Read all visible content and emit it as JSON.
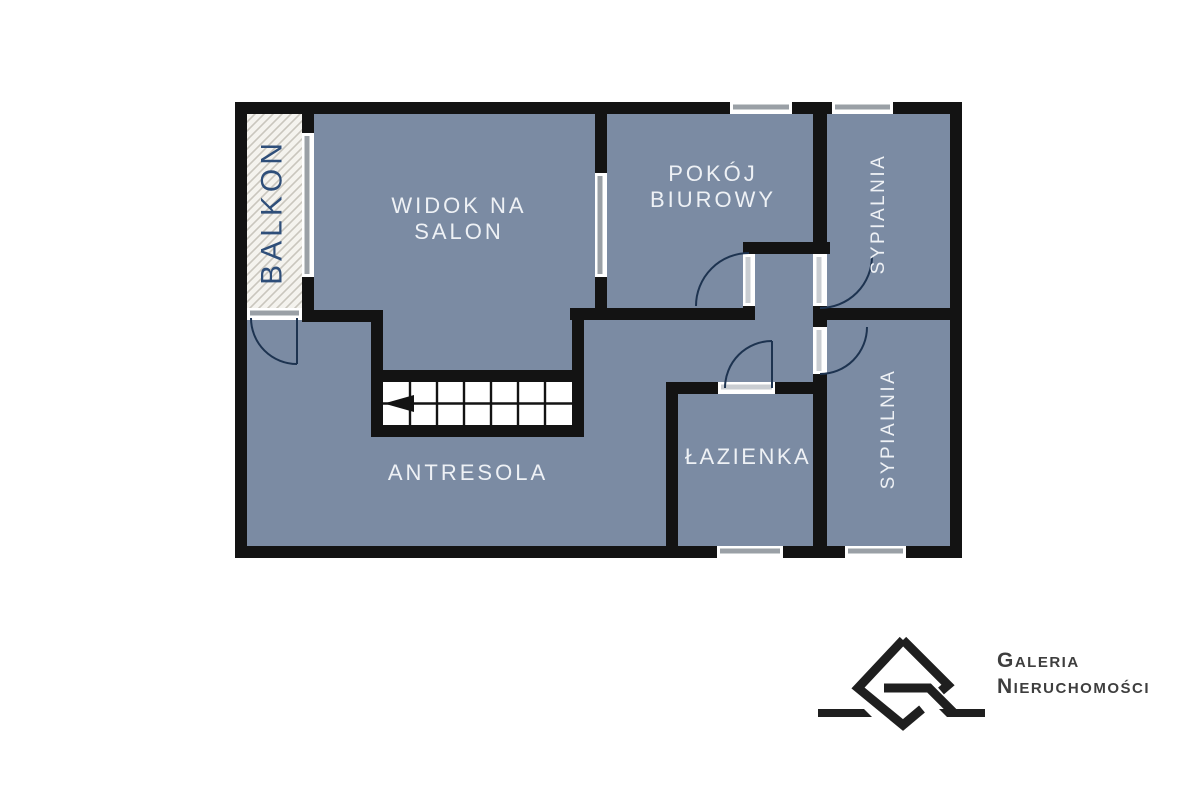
{
  "title": "Floor plan - mezzanine level",
  "rooms": {
    "balcony": {
      "label": "BALKON"
    },
    "salon": {
      "line1": "WIDOK NA",
      "line2": "SALON"
    },
    "office": {
      "line1": "POKÓJ",
      "line2": "BIUROWY"
    },
    "bedroom_top": {
      "label": "SYPIALNIA"
    },
    "bedroom_bottom": {
      "label": "SYPIALNIA"
    },
    "bathroom": {
      "label": "ŁAZIENKA"
    },
    "mezzanine": {
      "label": "ANTRESOLA"
    }
  },
  "stairs": {
    "columns": 7,
    "rows": 2,
    "direction_arrow": "left"
  },
  "logo": {
    "line1": "Galeria",
    "line2": "Nieruchomości"
  },
  "colors": {
    "wall": "#131313",
    "room_fill": "#7b8ba3",
    "balcony_hatch_bg": "#f4f3ee",
    "balcony_hatch_line": "#c9c6bd",
    "window_gray": "#9aa0a6",
    "balcony_label": "#2e4e79",
    "room_label": "#eef1f5",
    "door_arc": "#1d3350",
    "logo_ink": "#1f1f1f",
    "logo_text": "#3e3e3e"
  }
}
